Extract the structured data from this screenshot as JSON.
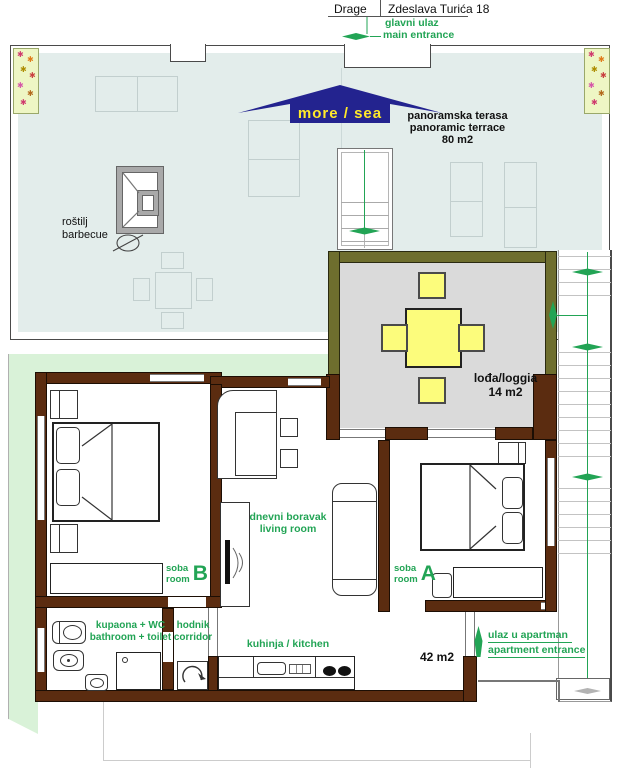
{
  "title": {
    "street_name": "Drage",
    "street_address": "Zdeslava Turića 18"
  },
  "main_entrance": {
    "hr": "glavni ulaz",
    "en": "main entrance"
  },
  "sea_direction": "more / sea",
  "terrace": {
    "hr": "panoramska terasa",
    "en": "panoramic terrace",
    "area": "80 m2"
  },
  "barbecue": {
    "hr": "roštilj",
    "en": "barbecue"
  },
  "loggia": {
    "name": "lođa/loggia",
    "area": "14 m2"
  },
  "living_room": {
    "hr": "dnevni boravak",
    "en": "living room"
  },
  "room_a": {
    "hr": "soba",
    "en": "room",
    "letter": "A"
  },
  "room_b": {
    "hr": "soba",
    "en": "room",
    "letter": "B"
  },
  "bathroom": {
    "hr": "kupaona + WC",
    "en": "bathroom + toilet"
  },
  "corridor": {
    "hr": "hodnik",
    "en": "corridor"
  },
  "kitchen": {
    "label": "kuhinja / kitchen"
  },
  "apartment": {
    "area": "42 m2"
  },
  "apartment_entrance": {
    "hr": "ulaz u apartman",
    "en": "apartment entrance"
  },
  "decor": {
    "flower_glyph": "✱",
    "flower_colors": [
      "#cf3a6e",
      "#e07b1a",
      "#ad8d00",
      "#c94040",
      "#d557a8",
      "#b36a1d"
    ]
  },
  "colors": {
    "wall": "#5b2c10",
    "terrace": "#e3edeb",
    "garden": "#d9f2d8",
    "loggia_floor": "#dadada",
    "loggia_wall": "#6e6e2e",
    "accent_green": "#22a455",
    "sea_arrow": "#23238f",
    "furniture_yellow": "#fcfc7c"
  }
}
